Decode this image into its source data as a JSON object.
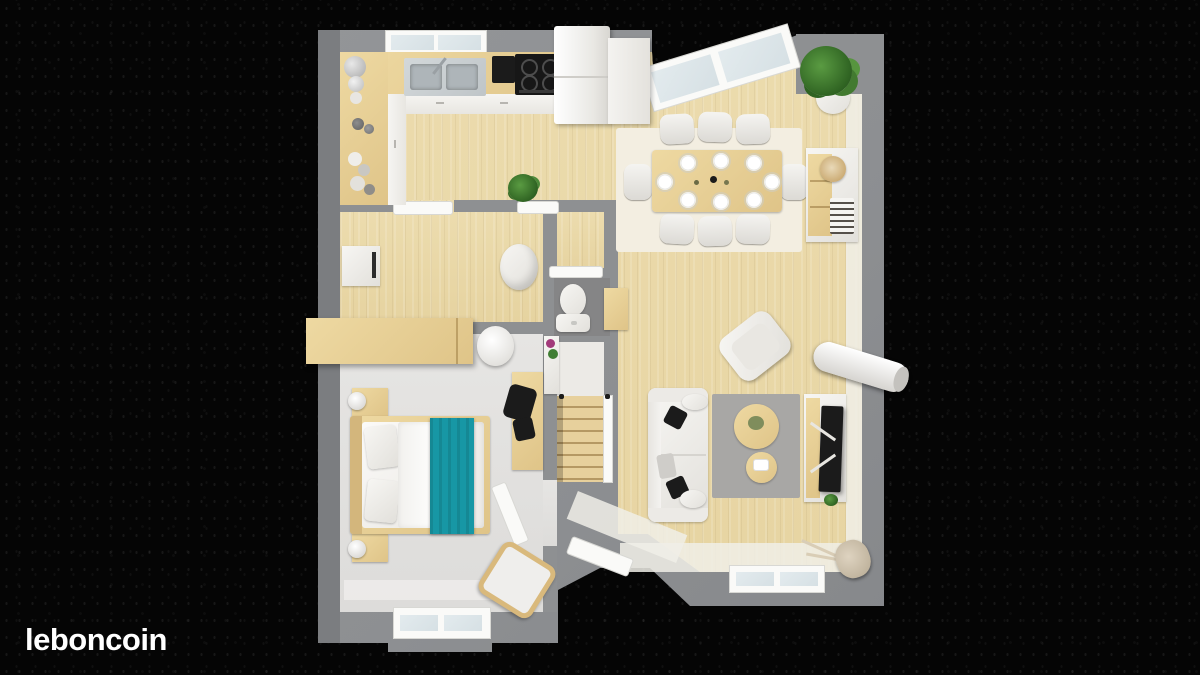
{
  "watermark": {
    "logo_text": "leboncoin"
  },
  "image": {
    "kind": "3D top-down floor plan render on dark speckled background",
    "palette": {
      "background": "#050505",
      "wall_gray": "#8e9092",
      "wood_floor": "#e9d8a8",
      "bedroom_floor": "#e2e1df",
      "rug_gray": "#a8a7a5",
      "dining_rug_cream": "#f3eee1",
      "throw_teal": "#1797a5",
      "furniture_white": "#f4f3f0",
      "tv_black": "#1b1b1b",
      "plant_green": "#3f7d33"
    }
  },
  "floor_plan": {
    "rooms": [
      {
        "name": "kitchen",
        "position": "top-left",
        "furniture": [
          "l-shaped-counter",
          "double-sink",
          "faucet",
          "coffee-machine",
          "cooktop-4-burners",
          "fridge",
          "tall-cabinet",
          "bottles-and-jars",
          "potted-plant",
          "double-window"
        ]
      },
      {
        "name": "dining-area",
        "position": "top-right",
        "furniture": [
          "dining-table",
          "eight-chairs",
          "eight-plates",
          "cream-rug",
          "sideboard-with-decor",
          "tall-corner-plant",
          "angled-glazed-wall"
        ]
      },
      {
        "name": "utility-room",
        "position": "middle-left",
        "furniture": [
          "washing-machine",
          "round-chair",
          "wardrobe",
          "paper-lantern",
          "door"
        ]
      },
      {
        "name": "wc",
        "position": "center",
        "furniture": [
          "toilet",
          "door",
          "side-cabinet"
        ]
      },
      {
        "name": "bedroom",
        "position": "bottom-left",
        "furniture": [
          "double-bed-teal-throw",
          "two-nightstands",
          "two-lamps",
          "desk",
          "black-office-chair",
          "accent-chair",
          "open-door",
          "double-window"
        ]
      },
      {
        "name": "living-room",
        "position": "bottom-right",
        "furniture": [
          "white-sofa",
          "dark-cushions",
          "gray-rug",
          "round-coffee-table",
          "round-side-table",
          "tv-console",
          "flat-tv",
          "armchair",
          "white-cylinder-bench",
          "floor-lamp",
          "staircase",
          "entrance-door",
          "bay-windows"
        ]
      }
    ],
    "counts": {
      "dining_chairs": 8,
      "plates": 8,
      "bedrooms": 1,
      "stair_flights": 1
    }
  }
}
